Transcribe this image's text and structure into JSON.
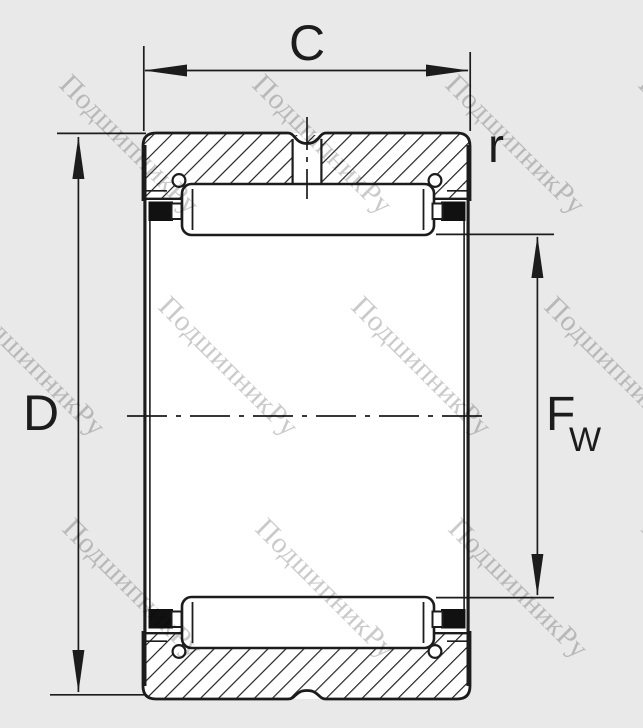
{
  "title": "Needle roller bearing cross-section technical drawing",
  "dimensions": {
    "width_label": "C",
    "outer_diameter_label": "D",
    "chamfer_label": "r",
    "bore_label_main": "F",
    "bore_label_sub": "W"
  },
  "watermark": {
    "text": "ПодшипникРу"
  },
  "colors": {
    "background": "#e9e9e9",
    "ink": "#1c1c1c",
    "paper_white": "#ffffff",
    "watermark_gray": "#9f9f9f",
    "seal_black": "#111111"
  }
}
